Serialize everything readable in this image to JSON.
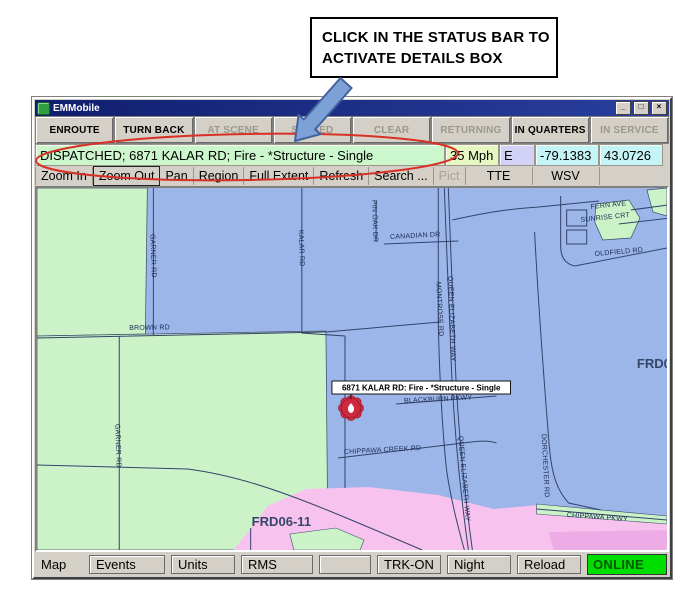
{
  "annotation": {
    "note_line1": "CLICK IN THE STATUS BAR TO",
    "note_line2": "ACTIVATE DETAILS BOX"
  },
  "window": {
    "title": "EMMobile",
    "controls": {
      "minimize": "_",
      "maximize": "□",
      "close": "×"
    }
  },
  "status_buttons": [
    {
      "label": "ENROUTE",
      "enabled": true
    },
    {
      "label": "TURN BACK",
      "enabled": true
    },
    {
      "label": "AT SCENE",
      "enabled": false
    },
    {
      "label": "STAGED",
      "enabled": false
    },
    {
      "label": "CLEAR",
      "enabled": false
    },
    {
      "label": "RETURNING",
      "enabled": false
    },
    {
      "label": "IN QUARTERS",
      "enabled": true
    },
    {
      "label": "IN SERVICE",
      "enabled": false
    }
  ],
  "status_bar": {
    "message": "DISPATCHED; 6871 KALAR RD; Fire - *Structure - Single",
    "speed": "35 Mph",
    "direction": "E",
    "longitude": "-79.1383",
    "latitude": "43.0726"
  },
  "toolbar": {
    "tools": [
      {
        "label": "Zoom In",
        "state": "normal"
      },
      {
        "label": "Zoom Out",
        "state": "active"
      },
      {
        "label": "Pan",
        "state": "normal"
      },
      {
        "label": "Region",
        "state": "normal"
      },
      {
        "label": "Full Extent",
        "state": "normal"
      },
      {
        "label": "Refresh",
        "state": "normal"
      },
      {
        "label": "Search ...",
        "state": "normal"
      },
      {
        "label": "Pict",
        "state": "disabled"
      },
      {
        "label": "TTE",
        "state": "normal"
      },
      {
        "label": "WSV",
        "state": "normal"
      }
    ]
  },
  "map": {
    "incident_label": "6871 KALAR RD: Fire - *Structure - Single",
    "zone_labels": [
      "FRD06-11",
      "FRD0"
    ],
    "road_labels": [
      "GARNER RD",
      "KALAR RD",
      "BROWN RD",
      "PIN OAK DR",
      "CANADIAN DR",
      "MONTROSE RD",
      "QUEEN ELIZABETH WAY",
      "QUEEN ELIZABETH WAY",
      "FERN AVE",
      "SUNRISE CRT",
      "OLDFIELD RD",
      "GARNER RD",
      "BLACKBURN PKWY",
      "CHIPPAWA CREEK RD",
      "DORCHESTER RD",
      "CHIPPAWA PKWY"
    ],
    "colors": {
      "region_blue": "#9cb6ea",
      "region_green": "#ccf2c8",
      "region_pink": "#f7c3ee",
      "incident_red": "#cf2840"
    }
  },
  "bottom_bar": {
    "map_label": "Map",
    "buttons": [
      "Events",
      "Units",
      "RMS",
      "",
      "TRK-ON",
      "Night",
      "Reload"
    ],
    "online": "ONLINE"
  }
}
